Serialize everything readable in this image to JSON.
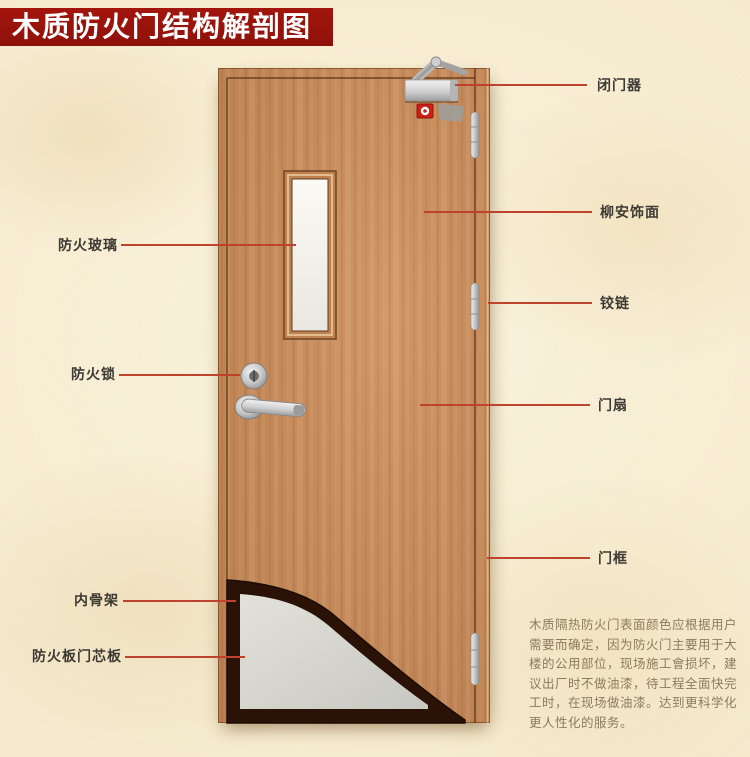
{
  "banner": {
    "title": "木质防火门结构解剖图",
    "background": "#98140b",
    "text_color": "#ffffff"
  },
  "diagram": {
    "labels_right": [
      {
        "id": "door-closer",
        "text": "闭门器"
      },
      {
        "id": "lauan-veneer",
        "text": "柳安饰面"
      },
      {
        "id": "hinge",
        "text": "铰链"
      },
      {
        "id": "door-leaf",
        "text": "门扇"
      },
      {
        "id": "door-frame",
        "text": "门框"
      }
    ],
    "labels_left": [
      {
        "id": "fire-glass",
        "text": "防火玻璃"
      },
      {
        "id": "fire-lock",
        "text": "防火锁"
      },
      {
        "id": "inner-skeleton",
        "text": "内骨架"
      },
      {
        "id": "core-board",
        "text": "防火板门芯板"
      }
    ],
    "note": "木质隔热防火门表面颜色应根据用户\n需要而确定，因为防火门主要用于大\n楼的公用部位，现场施工會损坏，建\n议出厂时不做油漆，待工程全面快完\n工时，在现场做油漆。达到更科学化\n更人性化的服务。"
  },
  "colors": {
    "background": "#f4e9cb",
    "door_wood": "#c88c5c",
    "leader_line": "#bf432c",
    "label_text": "#3d3933",
    "note_text": "#8b7c5d",
    "core_board_gray": "#d8d8d2",
    "skeleton_dark": "#2a1206",
    "fire_sticker_red": "#cf1f14"
  }
}
